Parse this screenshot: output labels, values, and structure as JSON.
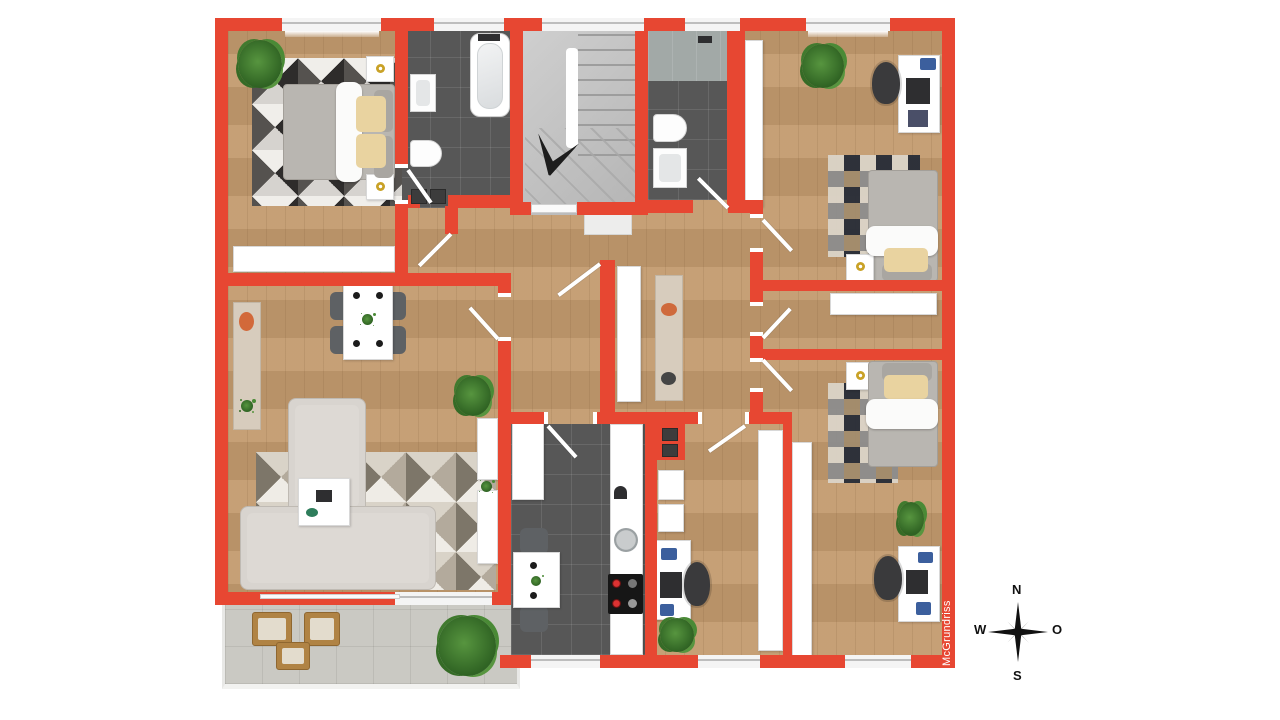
{
  "watermark": {
    "text": "McGrundriss"
  },
  "compass": {
    "north": "N",
    "west": "W",
    "east": "O",
    "south": "S"
  },
  "colors": {
    "wall_red": "#e74732",
    "wood_floor": "#c29a6e",
    "dark_tile": "#575757",
    "stair_gray": "#c2c2c2",
    "balcony_tile": "#cac9c3",
    "pillow_beige": "#e9d3a0",
    "accent_orange": "#d2693a",
    "plant_green": "#3f7a2e",
    "lamp_gold": "#c9a227",
    "desk_accent_blue": "#3c5f9d"
  }
}
